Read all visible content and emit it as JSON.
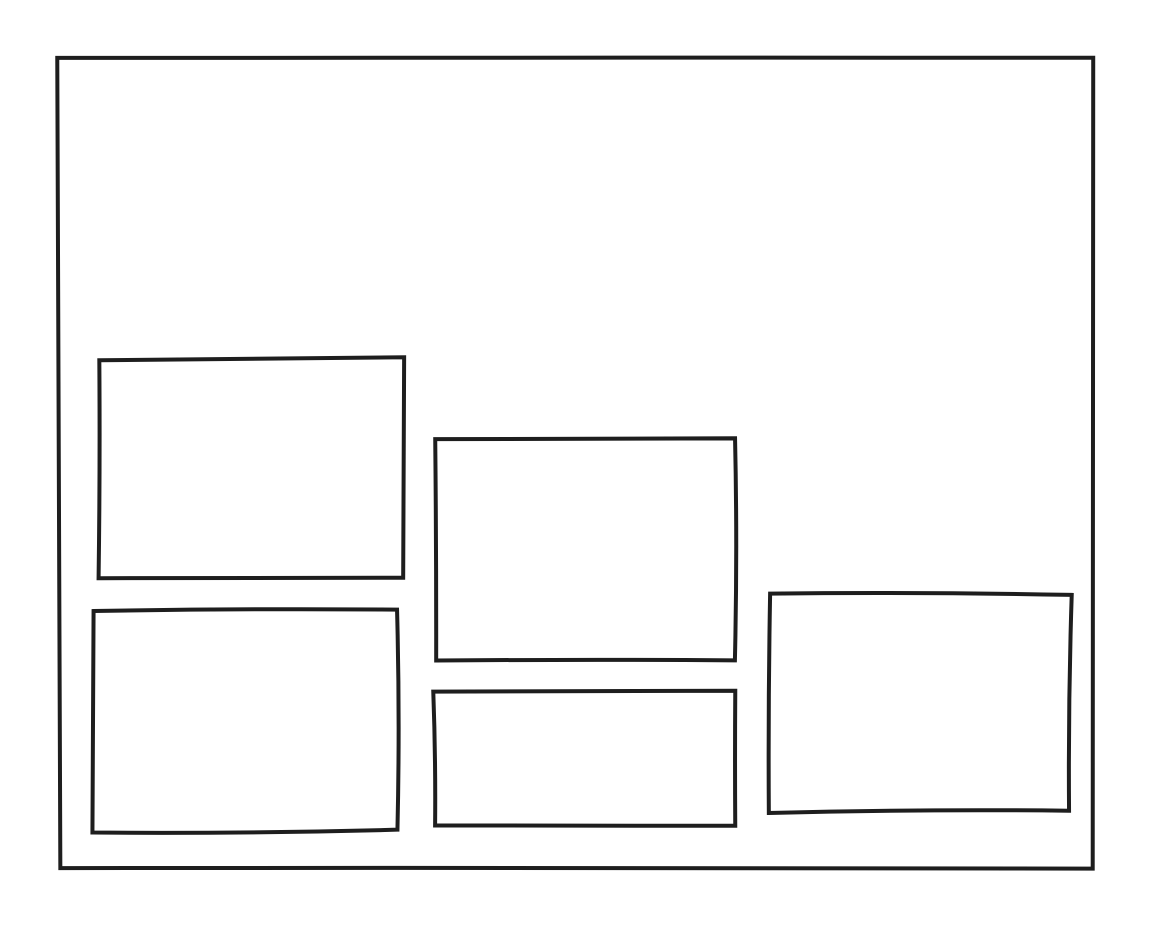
{
  "canvas": {
    "background": "#ffffff",
    "stroke_color": "#1e1e1e",
    "stroke_width": 4,
    "width": 1150,
    "height": 942
  },
  "sketch": {
    "style": "hand-drawn-wireframe",
    "shapes": [
      {
        "name": "outer-frame",
        "x": 59,
        "y": 58,
        "w": 1035,
        "h": 809
      },
      {
        "name": "panel-top-left",
        "x": 98,
        "y": 359,
        "w": 305,
        "h": 219
      },
      {
        "name": "panel-bottom-left",
        "x": 93,
        "y": 610,
        "w": 304,
        "h": 221
      },
      {
        "name": "panel-center",
        "x": 434,
        "y": 439,
        "w": 303,
        "h": 221
      },
      {
        "name": "panel-bottom-center",
        "x": 433,
        "y": 690,
        "w": 304,
        "h": 134
      },
      {
        "name": "panel-right",
        "x": 768,
        "y": 593,
        "w": 303,
        "h": 219
      }
    ]
  }
}
